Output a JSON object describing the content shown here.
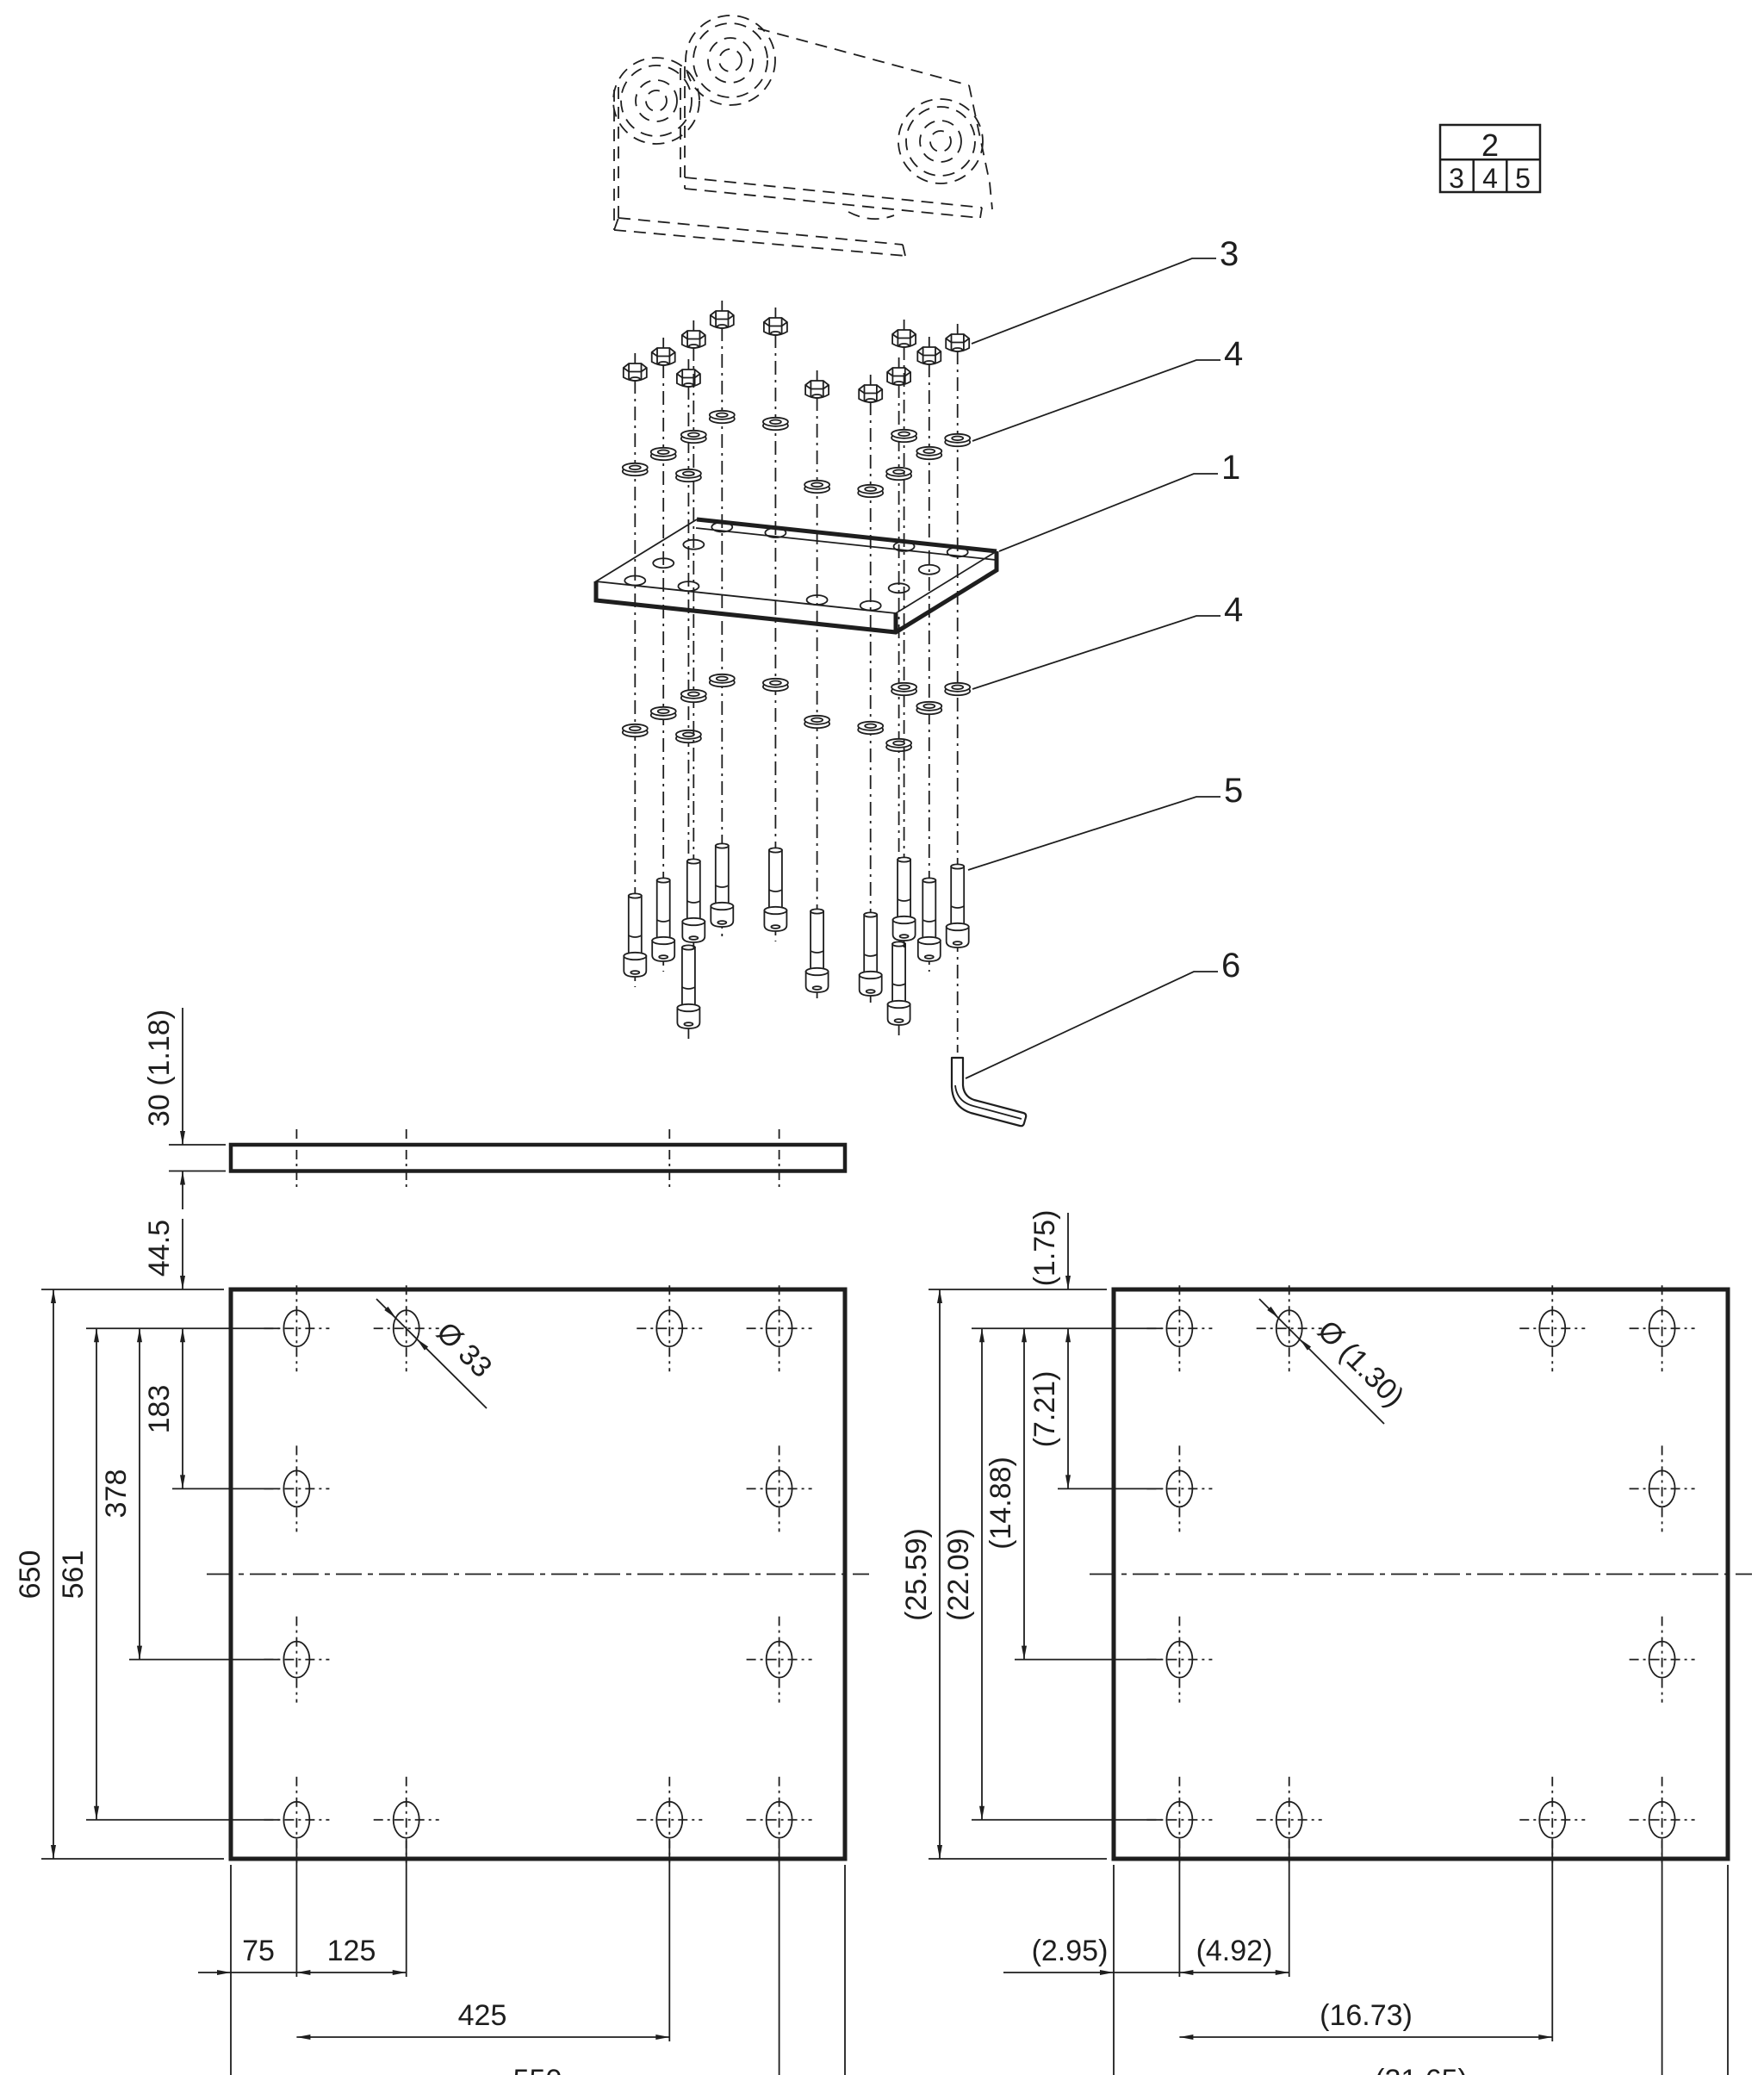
{
  "drawing": {
    "legend": {
      "parent": "2",
      "cells": [
        "3",
        "4",
        "5"
      ]
    },
    "callouts": {
      "nut": "3",
      "washer_upper": "4",
      "plate": "1",
      "washer_lower": "4",
      "screw": "5",
      "hex_key": "6"
    },
    "metric_view": {
      "thickness": "30 (1.18)",
      "top_offset": "44.5",
      "row_span_1": "183",
      "row_span_2": "378",
      "row_span_3": "561",
      "height": "650",
      "col_offset": "75",
      "col_span_1": "125",
      "col_span_2": "425",
      "col_span_3": "550",
      "width": "700",
      "hole_dia": "Ø 33"
    },
    "inch_view": {
      "top_offset": "(1.75)",
      "row_span_1": "(7.21)",
      "row_span_2": "(14.88)",
      "row_span_3": "(22.09)",
      "height": "(25.59)",
      "col_offset": "(2.95)",
      "col_span_1": "(4.92)",
      "col_span_2": "(16.73)",
      "col_span_3": "(21.65)",
      "width": "(27.56)",
      "hole_dia": "Ø (1.30)"
    }
  }
}
